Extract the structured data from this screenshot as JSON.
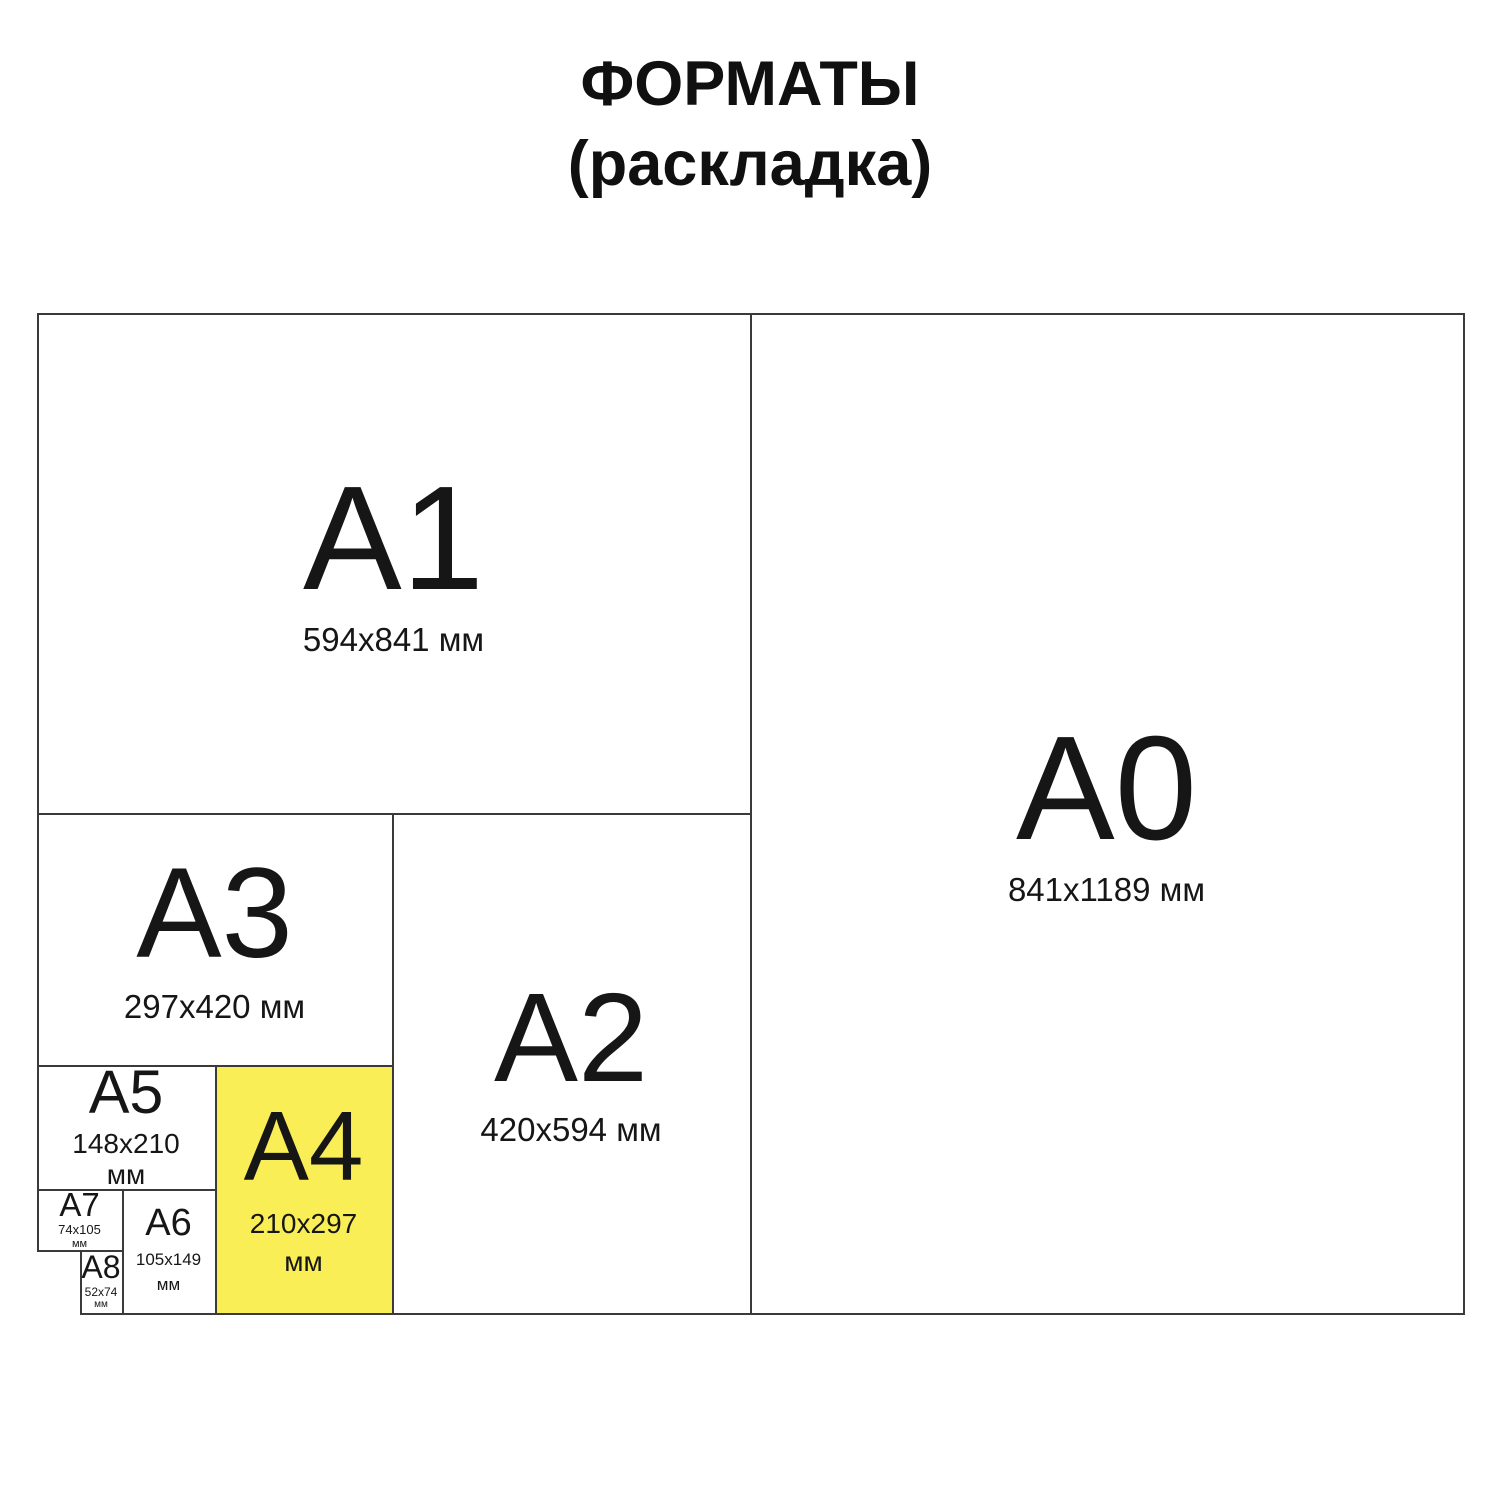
{
  "title": {
    "line1": "ФОРМАТЫ",
    "line2": "(раскладка)"
  },
  "formats": {
    "a0": {
      "name": "A0",
      "size": "841x1189 мм"
    },
    "a1": {
      "name": "A1",
      "size": "594x841 мм"
    },
    "a2": {
      "name": "A2",
      "size": "420x594 мм"
    },
    "a3": {
      "name": "A3",
      "size": "297x420 мм"
    },
    "a4": {
      "name": "A4",
      "size_line1": "210x297",
      "size_line2": "мм"
    },
    "a5": {
      "name": "A5",
      "size_line1": "148x210",
      "size_line2": "мм"
    },
    "a6": {
      "name": "A6",
      "size_line1": "105x149",
      "size_line2": "мм"
    },
    "a7": {
      "name": "A7",
      "size_line1": "74x105",
      "size_line2": "мм"
    },
    "a8": {
      "name": "A8",
      "size_line1": "52x74",
      "size_line2": "мм"
    }
  },
  "colors": {
    "highlight": "#F9EE55",
    "line": "#3A3A3A",
    "text": "#141414"
  }
}
